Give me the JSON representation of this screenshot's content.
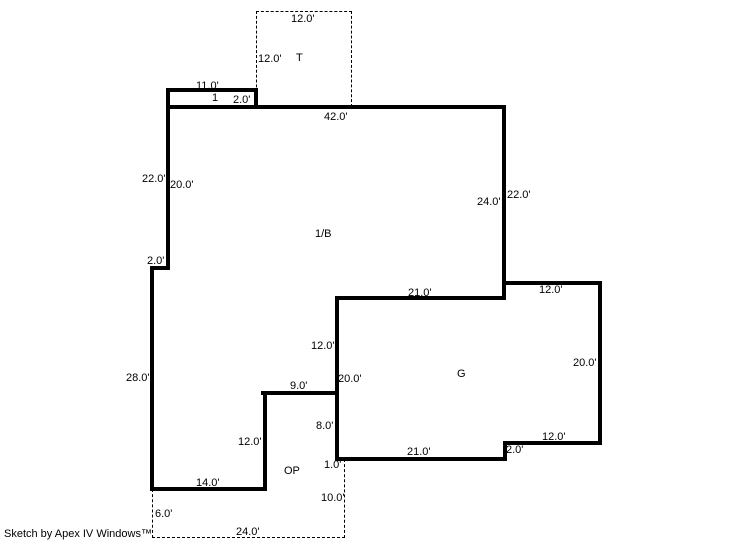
{
  "sketch": {
    "footer": "Sketch by Apex IV Windows™",
    "scale_px_per_foot": 8,
    "line_color": "#000000",
    "background_color": "#ffffff"
  },
  "areas": {
    "main": "1/B",
    "garage": "G",
    "open_porch": "OP",
    "t_area": "T",
    "porch": "1"
  },
  "dims": {
    "t_top": "12.0'",
    "t_left": "12.0'",
    "porch_top": "11.0'",
    "porch_depth": "2.0'",
    "main_top": "42.0'",
    "main_left_outer": "22.0'",
    "main_left_inner": "20.0'",
    "main_right_inner": "24.0'",
    "main_right_outer": "22.0'",
    "main_left_jog": "2.0'",
    "g_top": "21.0'",
    "g_ext_top": "12.0'",
    "g_left_upper": "12.0'",
    "main_left_lower": "28.0'",
    "g_left_total": "20.0'",
    "g_right": "20.0'",
    "op_top": "9.0'",
    "g_left_lower": "8.0'",
    "op_left_wall": "12.0'",
    "g_step": "2.0'",
    "g_bottom_right": "12.0'",
    "g_bottom": "21.0'",
    "op_gap": "1.0'",
    "op_right_dashed": "10.0'",
    "main_bottom": "14.0'",
    "op_left_dashed": "6.0'",
    "op_bottom_dashed": "24.0'"
  }
}
